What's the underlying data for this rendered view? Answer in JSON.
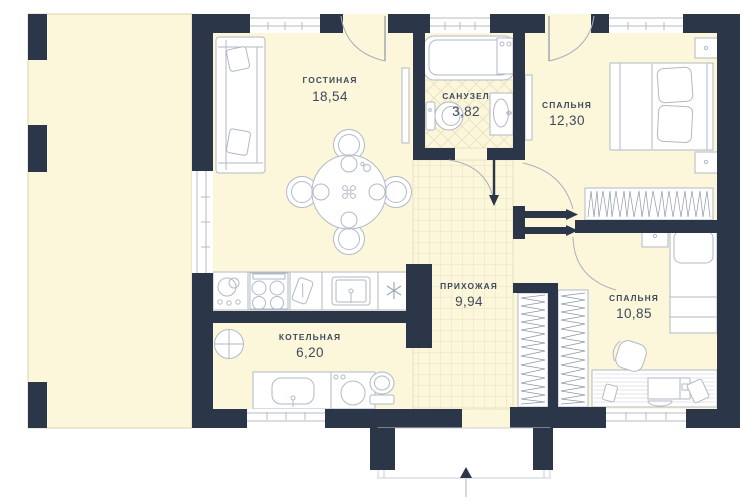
{
  "plan_title": "Apartment floor plan",
  "rooms": [
    {
      "id": "living",
      "name": "ГОСТИНАЯ",
      "area": "18,54",
      "furniture": [
        "sofa",
        "dining-table",
        "chairs",
        "plates",
        "kitchen-counter",
        "stove",
        "kitchen-sink",
        "cutting-board",
        "fridge"
      ]
    },
    {
      "id": "bathroom",
      "name": "САНУЗЕЛ",
      "area": "3,82",
      "furniture": [
        "bathtub",
        "toilet",
        "vanity-sink",
        "cabinet"
      ]
    },
    {
      "id": "bedroom-1",
      "name": "СПАЛЬНЯ",
      "area": "12,30",
      "furniture": [
        "double-bed",
        "nightstand",
        "nightstand",
        "wardrobe"
      ]
    },
    {
      "id": "hallway",
      "name": "ПРИХОЖАЯ",
      "area": "9,94",
      "furniture": [
        "wardrobe",
        "wardrobe"
      ]
    },
    {
      "id": "boiler",
      "name": "КОТЕЛЬНАЯ",
      "area": "6,20",
      "furniture": [
        "boiler",
        "vanity-sink",
        "washing-machine",
        "toilet"
      ]
    },
    {
      "id": "bedroom-2",
      "name": "СПАЛЬНЯ",
      "area": "10,85",
      "furniture": [
        "single-bed",
        "nightstand",
        "desk",
        "laptop",
        "chair"
      ]
    }
  ],
  "colors": {
    "wall": "#2b3648",
    "floor": "#fcf7db",
    "furniture_stroke": "#b2b9c4",
    "label_text": "#3e4a5b",
    "tile_line": "#e7e0c2"
  },
  "markers": [
    "entry-arrow",
    "bathroom-entry-arrow",
    "bedroom1-entry-arrow",
    "bedroom2-entry-arrow"
  ]
}
